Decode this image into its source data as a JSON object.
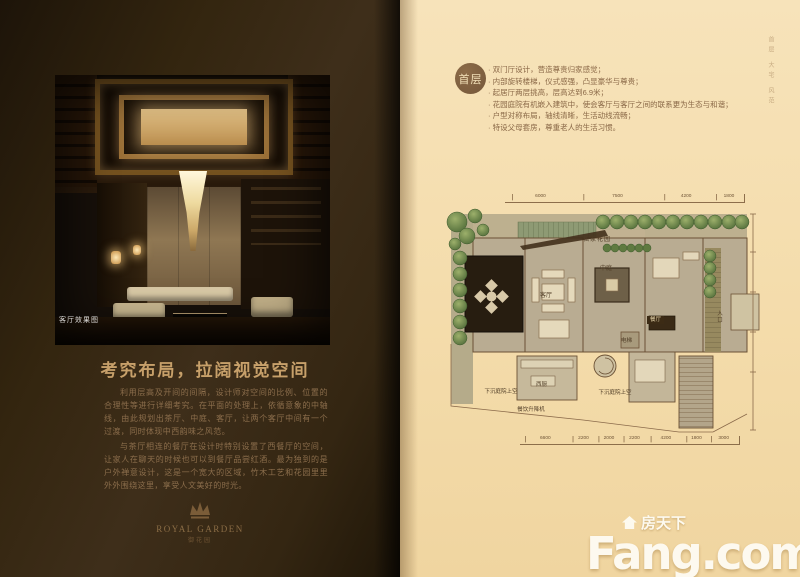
{
  "left_page": {
    "photo_caption": "客厅效果图",
    "heading": "考究布局，拉阔视觉空间",
    "paragraphs": [
      "利用层高及开间的间隔，设计师对空间的比例、位置的合理性等进行详细考究。在平面的处理上，依循意象的中轴线，由此规划出茶厅、中庭、客厅，让两个客厅中间有一个过渡，同时体现中西韵味之风范。",
      "与茶厅相连的餐厅在设计时特别设置了西餐厅的空间，让家人在聊天的时候也可以到餐厅品尝红酒。最为独到的是户外禅意设计，这是一个宽大的区域，竹木工艺和花园里里外外围绕这里，享受人文美好的时光。"
    ],
    "logo": {
      "en": "ROYAL GARDEN",
      "cn": "御花园"
    }
  },
  "right_page": {
    "floor_badge": "首层",
    "bullets": [
      "双门厅设计，营造尊贵归家感觉；",
      "内部旋转楼梯，仪式感强，凸显豪华与尊贵；",
      "起居厅两层挑高，层高达到6.9米；",
      "花园庭院有机嵌入建筑中，使会客厅与客厅之间的联系更为生态与和谐；",
      "户型对称布局，轴线清晰，生活动线流畅；",
      "特设父母套房，尊重老人的生活习惯。"
    ],
    "side_note": "首层 大宅 风范",
    "floorplan": {
      "labels": {
        "private_garden": "私家花园",
        "living_room": "客厅",
        "atrium": "中庭",
        "dining_room": "餐厅",
        "elevator": "电梯",
        "west_kitchen": "西厨",
        "sunken_courtyard_left": "下沉庭院上空",
        "sunken_courtyard_right": "下沉庭院上空",
        "dumbwaiter": "餐饮升降机",
        "entrance": "入口"
      },
      "dimensions_top": [
        "6000",
        "7500",
        "4200",
        "1800"
      ],
      "dimensions_bottom": [
        "6600",
        "2200",
        "2000",
        "2200",
        "4200",
        "1800",
        "3000"
      ]
    }
  },
  "watermark": {
    "site_cn": "房天下",
    "site_en": "Fang.com"
  },
  "colors": {
    "left_page_bg": "#342612",
    "right_page_bg": "#f4dcab",
    "accent_gold": "#c7a06a",
    "plan_green": "#6d8347",
    "badge_brown": "#74573a",
    "watermark_white": "#fffdf6"
  }
}
